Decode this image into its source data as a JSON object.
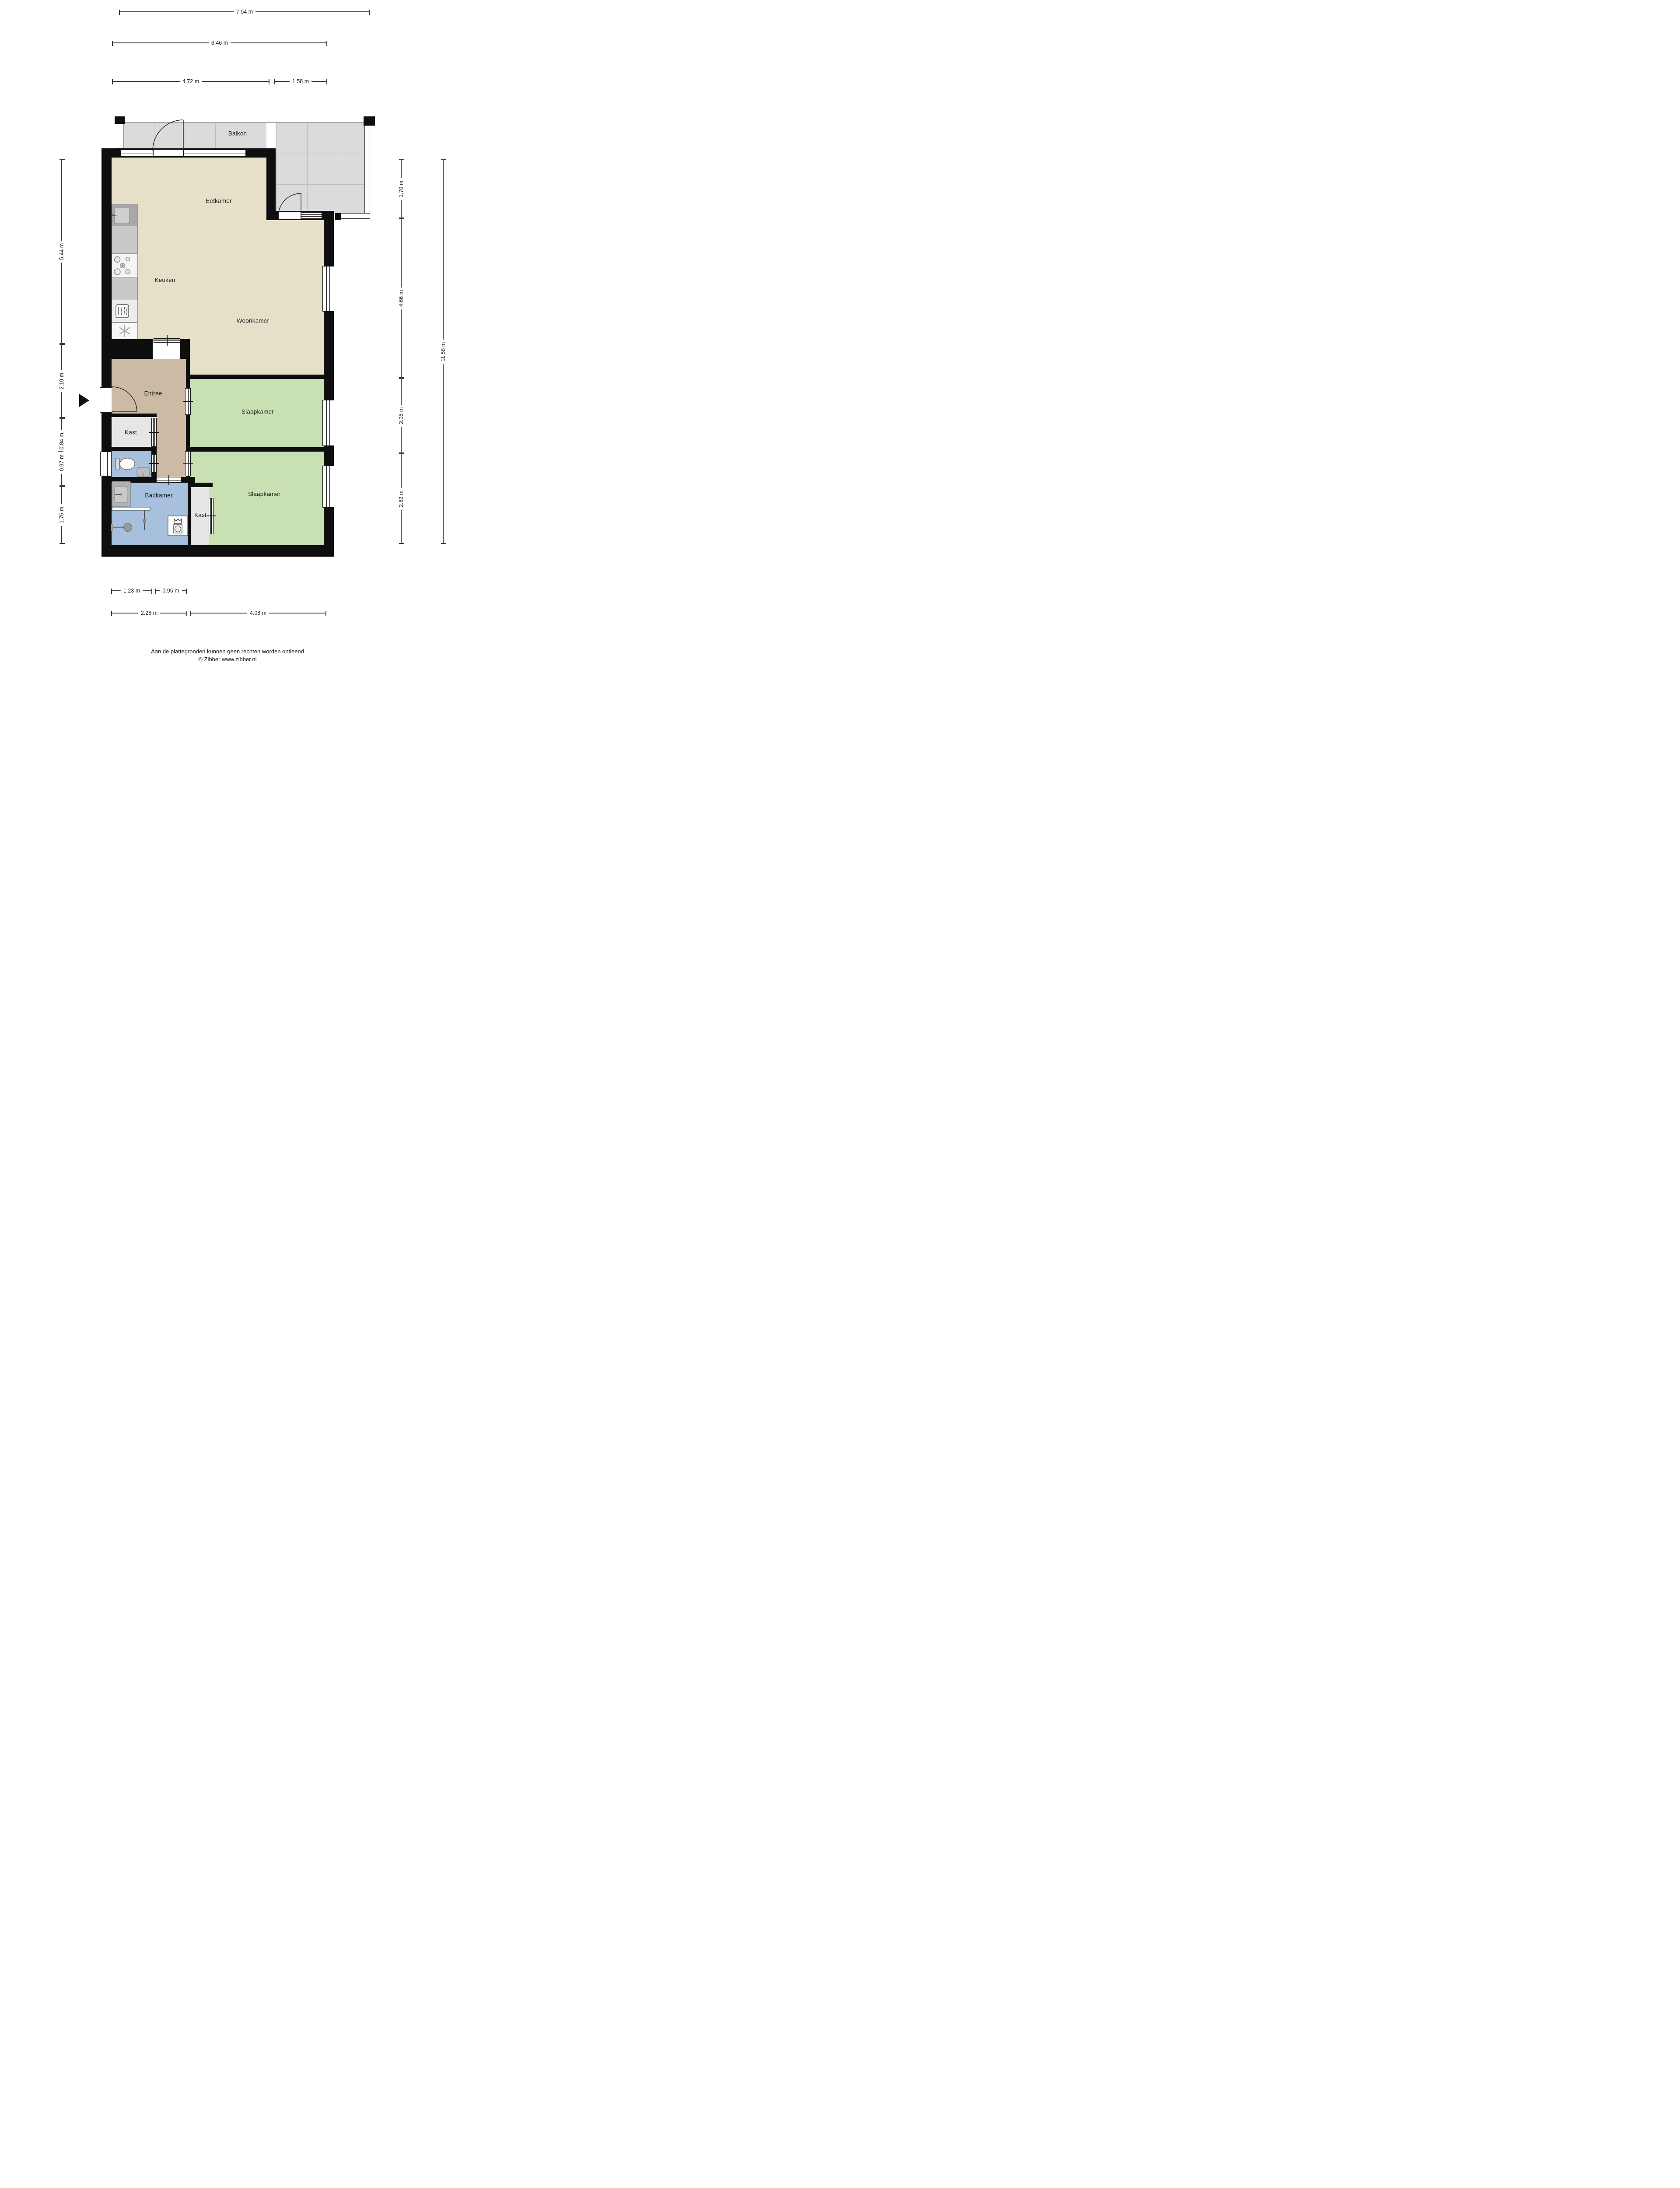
{
  "rooms": {
    "balkon": "Balkon",
    "eetkamer": "Eetkamer",
    "keuken": "Keuken",
    "woonkamer": "Woonkamer",
    "entree": "Entree",
    "kast_hal": "Kast",
    "slaapkamer_1": "Slaapkamer",
    "badkamer": "Badkamer",
    "kast_slaapkamer": "Kast",
    "slaapkamer_2": "Slaapkamer"
  },
  "dimensions": {
    "top": [
      "7.54 m",
      "6.46 m",
      "4.72 m",
      "1.58 m"
    ],
    "left": [
      "5.44 m",
      "2.19 m",
      "0.97 m - 0.84 m",
      "1.76 m"
    ],
    "right": [
      "1.70 m",
      "4.66 m",
      "2.05 m",
      "2.82 m",
      "11.58 m"
    ],
    "bottom": [
      "1.23 m",
      "0.95 m",
      "2.28 m",
      "4.08 m"
    ]
  },
  "footer": {
    "disclaimer": "Aan de plattegronden kunnen geen rechten worden ontleend",
    "copyright": "© Zibber www.zibber.nl"
  },
  "colors": {
    "wall": "#0e0e0e",
    "living_floor": "#e7e0c9",
    "hall_floor": "#ccbaa5",
    "bedroom_floor": "#c9e0b3",
    "bath_floor": "#a6c0dd",
    "closet_floor": "#e6e6e6",
    "balcony_tile": "#dbdbdd",
    "kitchen_counter": "#c9c9c9",
    "dark_cabinet": "#686868"
  },
  "icons": [
    "sink-icon",
    "stove-icon",
    "oven-icon",
    "fridge-snowflake-icon",
    "toilet-icon",
    "hand-basin-icon",
    "shower-icon",
    "washing-machine-icon",
    "door-swing-icon",
    "entrance-arrow-icon"
  ]
}
